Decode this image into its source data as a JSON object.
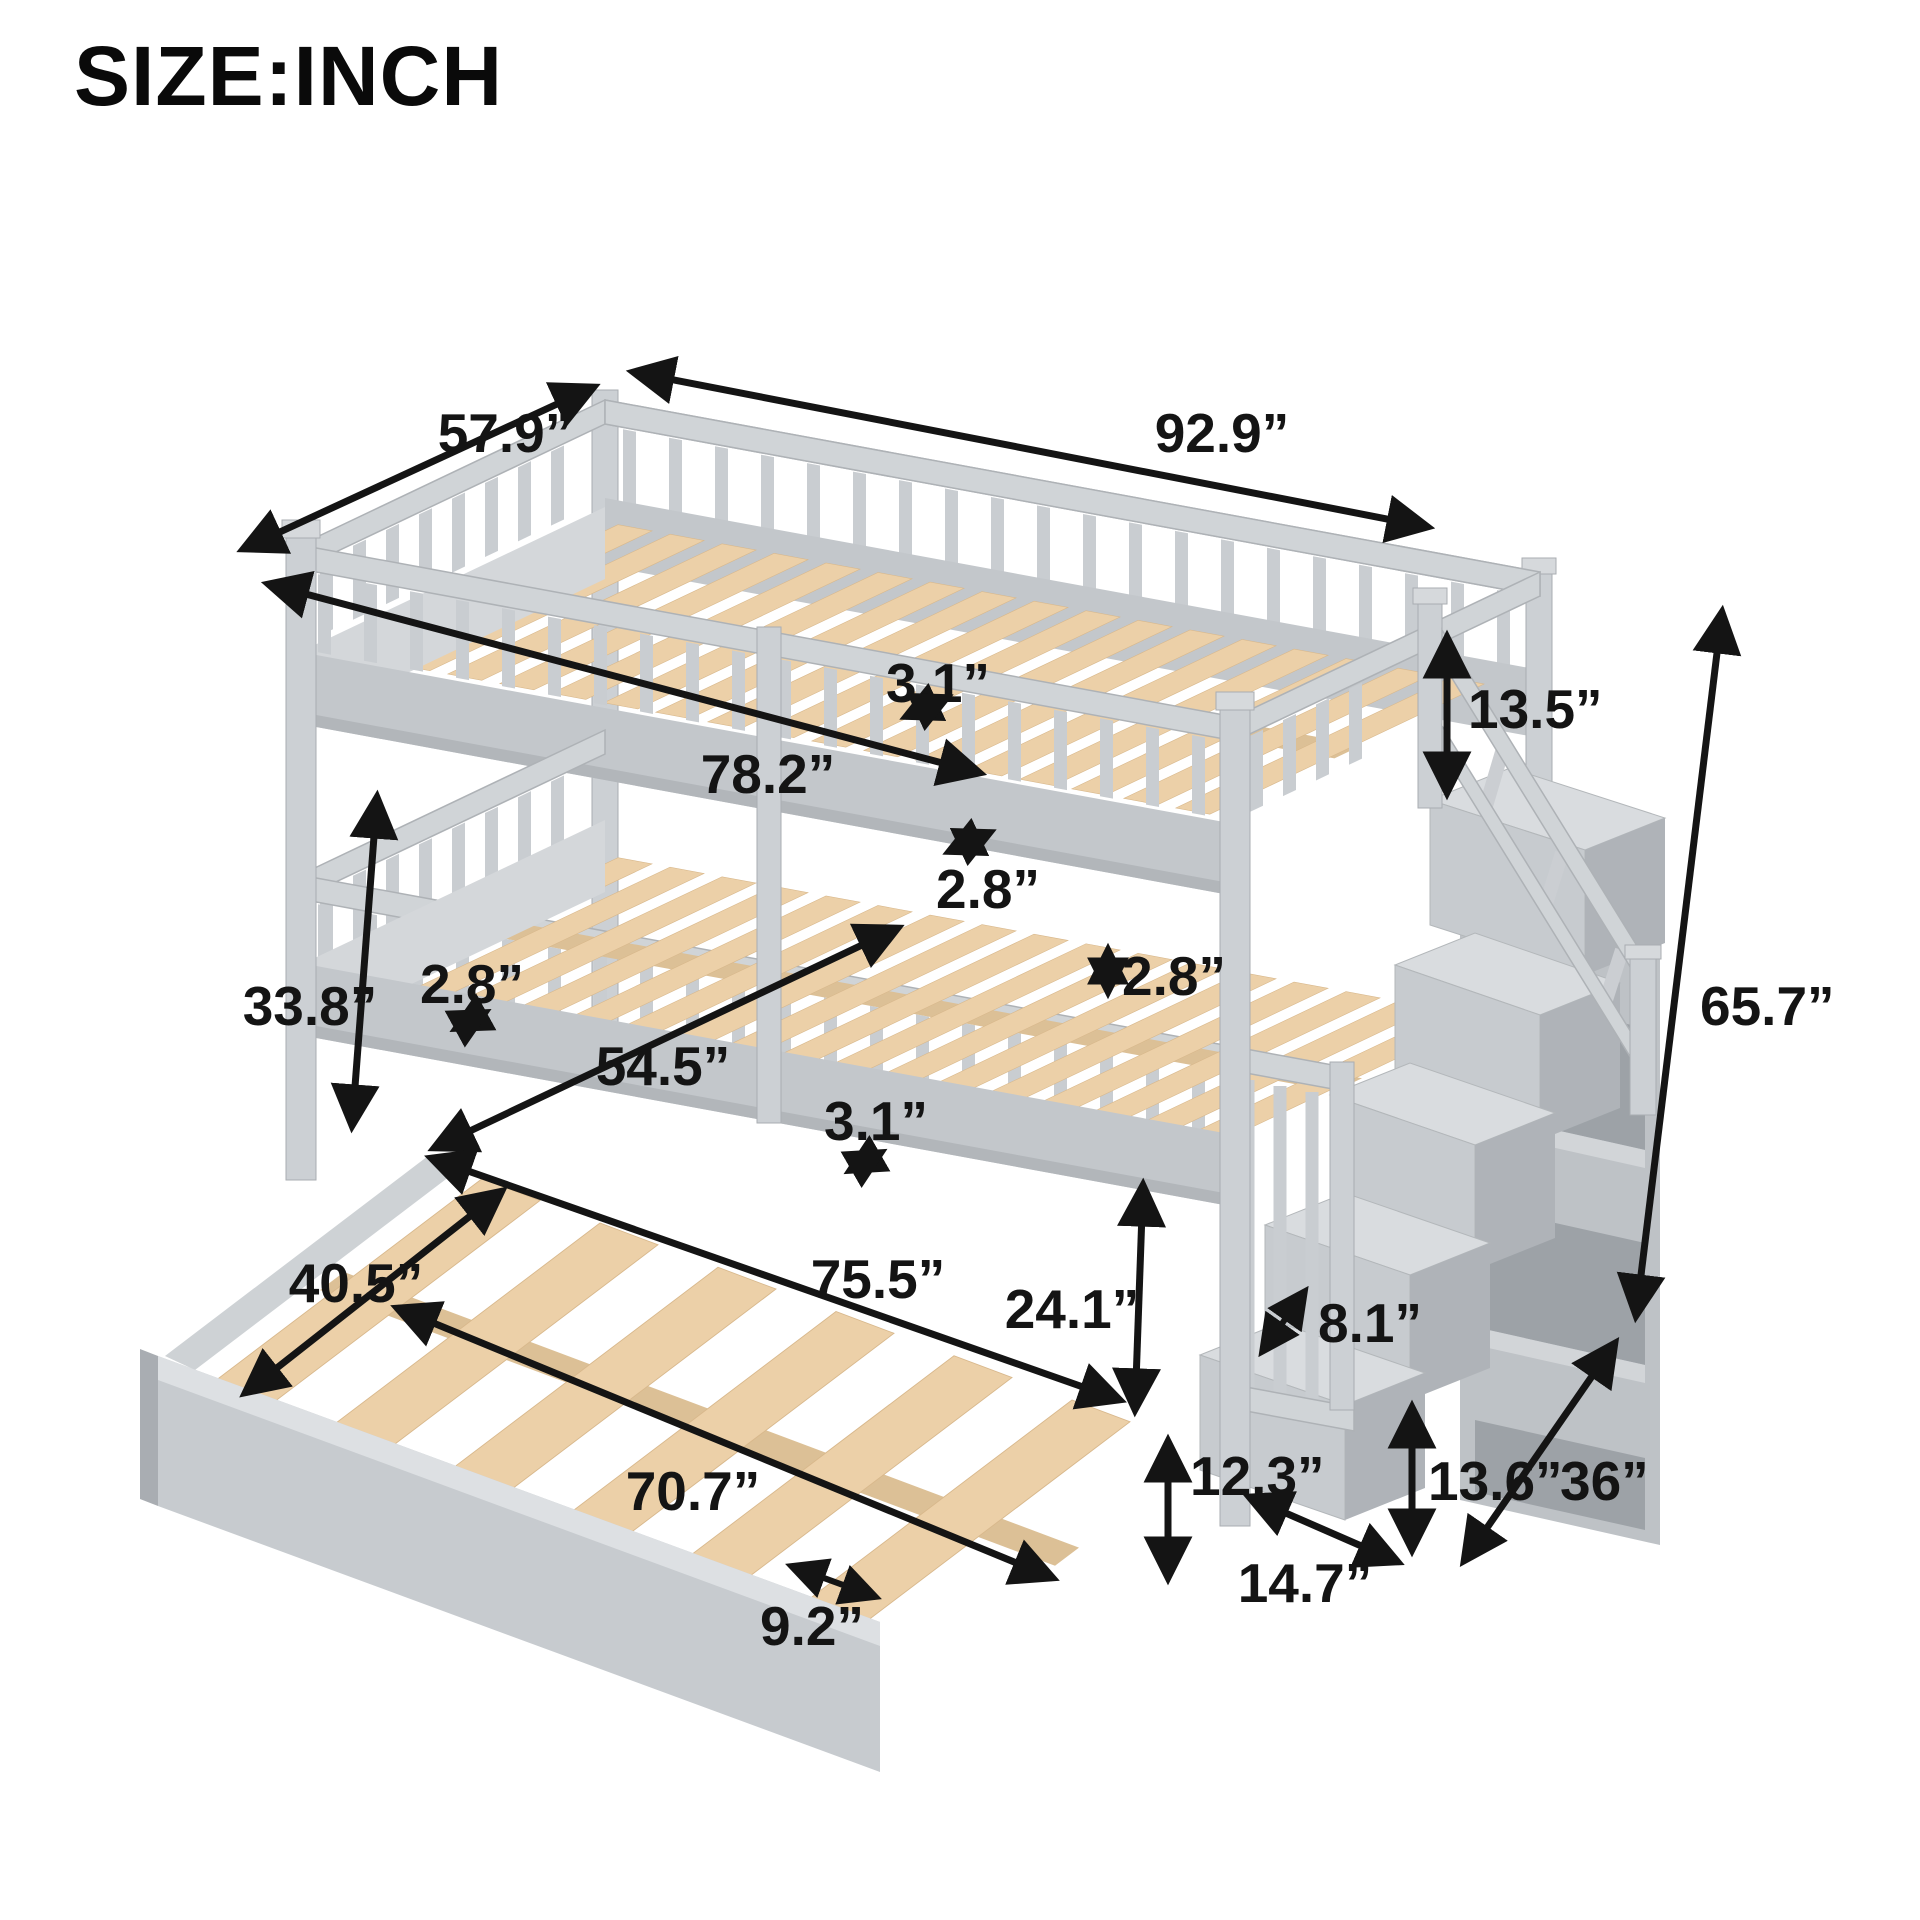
{
  "title": "SIZE:INCH",
  "palette": {
    "background": "#ffffff",
    "label_color": "#141414",
    "frame_gray": "#cdd1d4",
    "frame_shadow": "#aeb2b6",
    "slat_wood": "#ecd0a8"
  },
  "dimensions": [
    {
      "name": "overall-depth",
      "label": "57.9”"
    },
    {
      "name": "overall-length",
      "label": "92.9”"
    },
    {
      "name": "top-slat-width",
      "label": "3.1”"
    },
    {
      "name": "top-bunk-inner-length",
      "label": "78.2”"
    },
    {
      "name": "top-guardrail-height",
      "label": "13.5”"
    },
    {
      "name": "top-slat-gap",
      "label": "2.8”"
    },
    {
      "name": "rail-thickness",
      "label": "2.8”"
    },
    {
      "name": "bunk-spacing-height",
      "label": "33.8”"
    },
    {
      "name": "lower-rail-width",
      "label": "2.8”"
    },
    {
      "name": "bottom-bunk-inner-width",
      "label": "54.5”"
    },
    {
      "name": "bottom-slat-width",
      "label": "3.1”"
    },
    {
      "name": "overall-height",
      "label": "65.7”"
    },
    {
      "name": "trundle-width",
      "label": "40.5”"
    },
    {
      "name": "bottom-bunk-inner-length",
      "label": "75.5”"
    },
    {
      "name": "bottom-bunk-clearance",
      "label": "24.1”"
    },
    {
      "name": "stair-tread-depth",
      "label": "8.1”"
    },
    {
      "name": "trundle-length",
      "label": "70.7”"
    },
    {
      "name": "under-bed-clearance",
      "label": "12.3”"
    },
    {
      "name": "bottom-step-height",
      "label": "13.6”"
    },
    {
      "name": "staircase-depth",
      "label": "36”"
    },
    {
      "name": "trundle-slat-gap",
      "label": "9.2”"
    },
    {
      "name": "stair-step-width",
      "label": "14.7”"
    }
  ]
}
